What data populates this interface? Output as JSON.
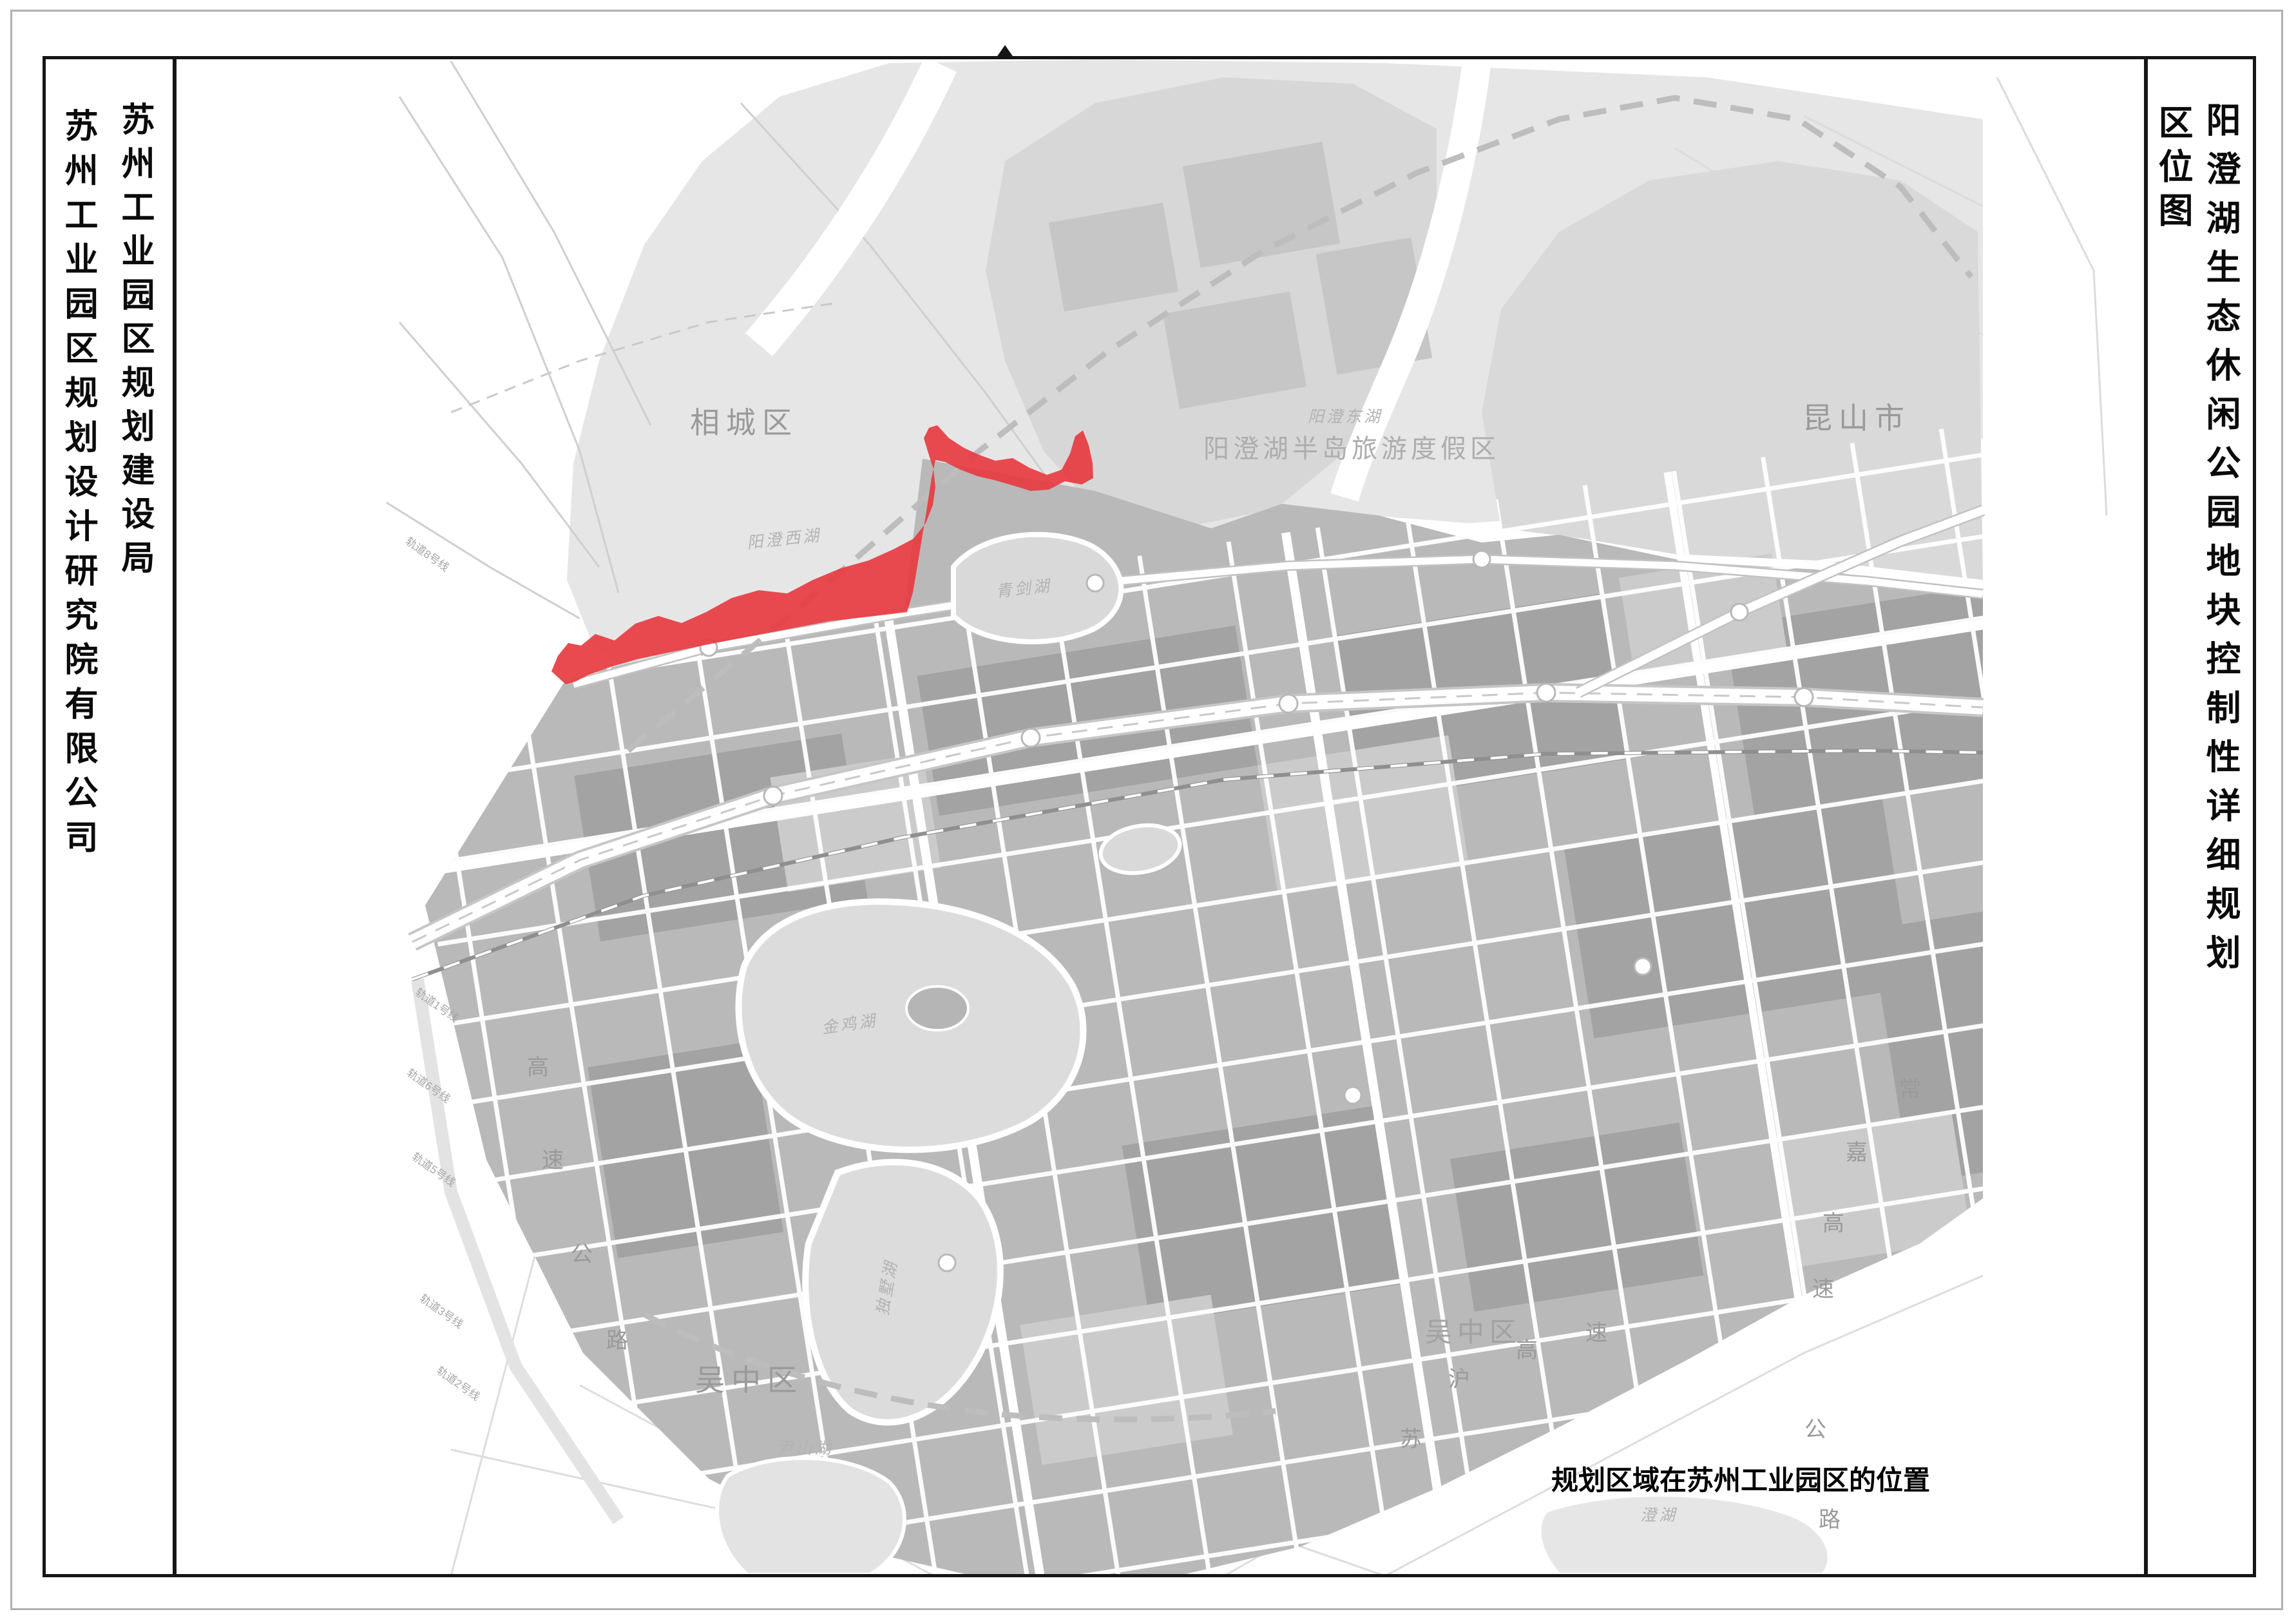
{
  "left_panel": {
    "org1": "苏州工业园区规划建设局",
    "org2": "苏州工业园区规划设计研究院有限公司"
  },
  "right_panel": {
    "title": "阳澄湖生态休闲公园地块控制性详细规划",
    "subtitle": "区位图"
  },
  "map": {
    "caption": "规划区域在苏州工业园区的位置",
    "district_labels": [
      {
        "t": "相城区"
      },
      {
        "t": "昆山市"
      },
      {
        "t": "吴中区"
      },
      {
        "t": "吴中区"
      }
    ],
    "area_labels": [
      {
        "t": "阳澄湖半岛旅游度假区"
      }
    ],
    "water_labels": [
      {
        "t": "阳澄西湖"
      },
      {
        "t": "阳澄东湖"
      },
      {
        "t": "青剑湖"
      },
      {
        "t": "金鸡湖"
      },
      {
        "t": "独墅湖"
      },
      {
        "t": "尹山湖"
      },
      {
        "t": "澄湖"
      }
    ],
    "road_chars": [
      {
        "t": "苏"
      },
      {
        "t": "沪"
      },
      {
        "t": "高"
      },
      {
        "t": "速"
      },
      {
        "t": "公"
      },
      {
        "t": "路"
      },
      {
        "t": "高"
      },
      {
        "t": "速"
      },
      {
        "t": "公"
      },
      {
        "t": "路"
      },
      {
        "t": "常"
      },
      {
        "t": "嘉"
      },
      {
        "t": "高"
      },
      {
        "t": "速"
      }
    ],
    "metro_labels": [
      {
        "t": "轨道8号线"
      },
      {
        "t": "轨道1号线"
      },
      {
        "t": "轨道6号线"
      },
      {
        "t": "轨道5号线"
      },
      {
        "t": "轨道3号线"
      },
      {
        "t": "轨道2号线"
      }
    ]
  },
  "colors": {
    "highlight": "#e73c42",
    "frame": "#161616",
    "border": "#b0b0b0",
    "label": "#9a9a9a",
    "water": "#e6e6e6",
    "urban": "#b9b9b9",
    "darkblock": "#a3a3a3",
    "lightblock": "#cbcbcb",
    "lake": "#dcdcdc",
    "dash": "#bdbdbd"
  }
}
